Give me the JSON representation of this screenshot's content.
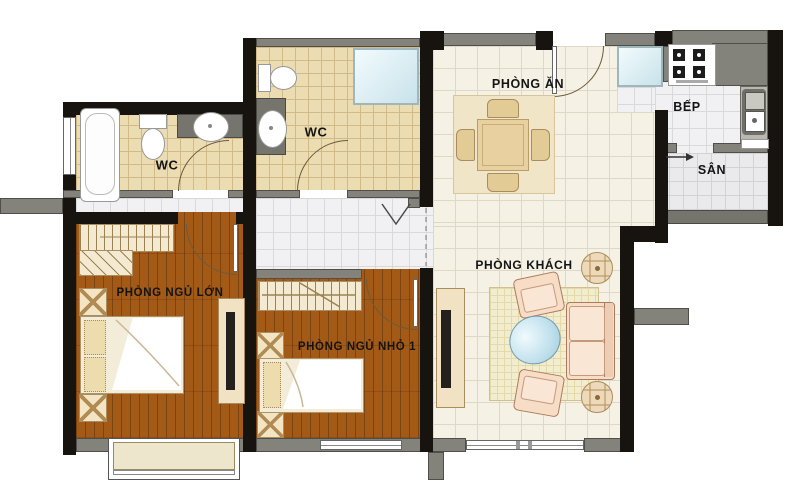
{
  "title": "Apartment floor plan",
  "rooms": {
    "dining": {
      "label": "PHÒNG ĂN"
    },
    "kitchen": {
      "label": "BẾP"
    },
    "yard": {
      "label": "SÂN"
    },
    "bath_master": {
      "label": "WC"
    },
    "bath_second": {
      "label": "WC"
    },
    "bedroom_master": {
      "label": "PHÒNG NGỦ LỚN"
    },
    "bedroom_small": {
      "label": "PHÒNG NGỦ NHỎ 1"
    },
    "living": {
      "label": "PHÒNG KHÁCH"
    }
  },
  "palette": {
    "wall_black": "#17130e",
    "wall_gray": "#83837c",
    "wood_floor": "#a35a17",
    "bath_tile": "#ecdcb2",
    "main_tile": "#f5f1e4",
    "service_tile": "#f1f1f3",
    "upholstery": "#f7dcc6",
    "glass": "#dff0f5"
  }
}
